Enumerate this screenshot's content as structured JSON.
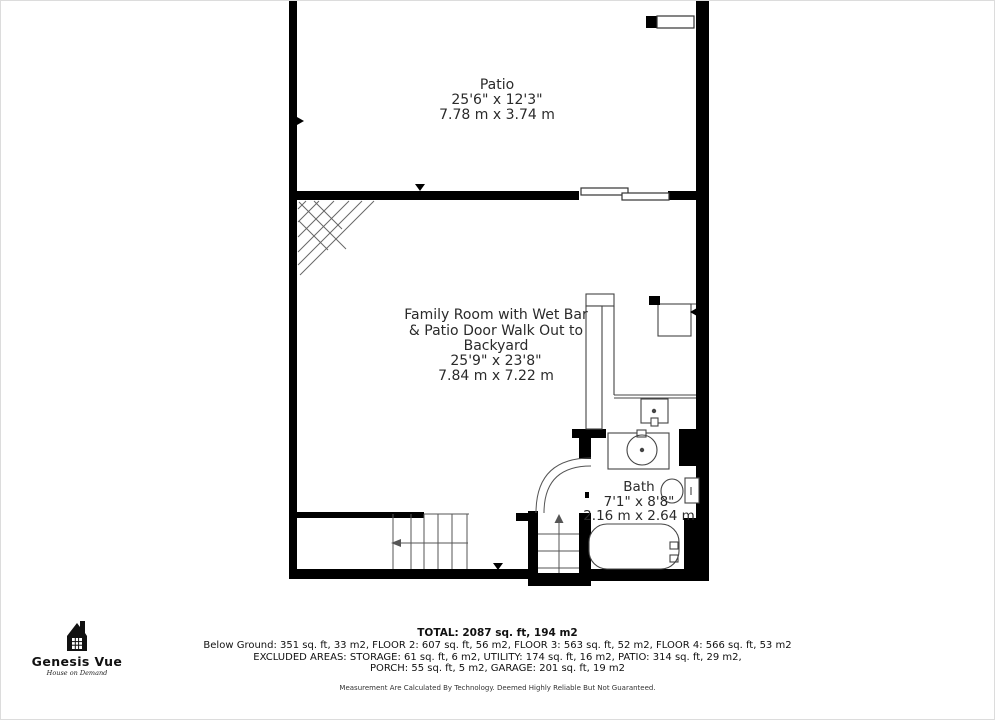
{
  "plan": {
    "rooms": {
      "patio": {
        "name": "Patio",
        "imperial": "25'6\" x 12'3\"",
        "metric": "7.78 m x 3.74 m"
      },
      "family_room": {
        "name": "Family Room with Wet Bar\n& Patio Door Walk Out to\nBackyard",
        "imperial": "25'9\" x 23'8\"",
        "metric": "7.84 m x 7.22 m"
      },
      "bath": {
        "name": "Bath",
        "imperial": "7'1\" x 8'8\"",
        "metric": "2.16 m x 2.64 m"
      }
    },
    "features": [
      "sliding-patio-door",
      "corner-stairs",
      "lower-stairs",
      "stairwell",
      "wet-bar-sink",
      "bar-fridge",
      "vanity-sink",
      "toilet",
      "bathtub",
      "bath-door-swing"
    ]
  },
  "footer": {
    "total": "TOTAL: 2087 sq. ft, 194 m2",
    "line1": "Below Ground: 351 sq. ft, 33 m2, FLOOR 2: 607 sq. ft, 56 m2, FLOOR 3: 563 sq. ft, 52 m2, FLOOR 4: 566 sq. ft, 53 m2",
    "line2": "EXCLUDED AREAS: STORAGE: 61 sq. ft, 6 m2, UTILITY: 174 sq. ft, 16 m2, PATIO: 314 sq. ft, 29 m2,",
    "line3": "PORCH: 55 sq. ft, 5 m2, GARAGE: 201 sq. ft, 19 m2",
    "disclaimer": "Measurement Are Calculated By Technology. Deemed Highly Reliable But Not Guaranteed."
  },
  "logo": {
    "brand": "Genesis Vue",
    "tagline": "House on Demand",
    "icon": "house-icon"
  },
  "colors": {
    "wall": "#000000",
    "line": "#555555",
    "background": "#ffffff",
    "text": "#2a2a2a"
  }
}
